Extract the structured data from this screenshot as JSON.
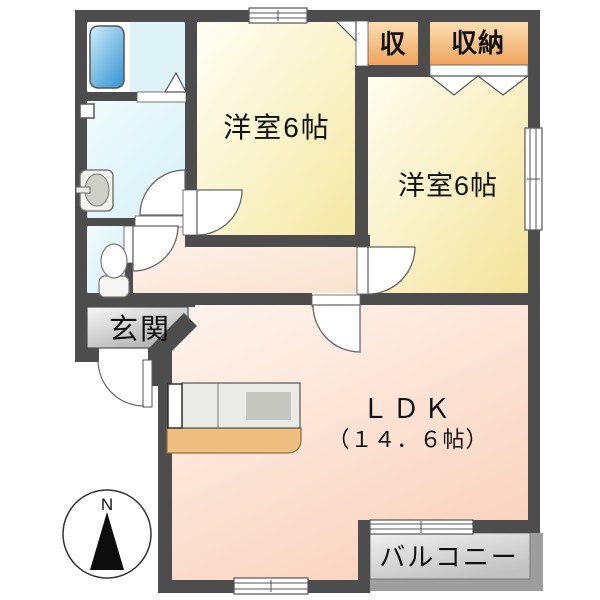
{
  "plan": {
    "rooms": {
      "bedroom1": {
        "label": "洋室6帖"
      },
      "bedroom2": {
        "label": "洋室6帖"
      },
      "ldk": {
        "label": "ＬＤＫ",
        "size": "（１４．６帖）"
      },
      "entrance": {
        "label": "玄関"
      },
      "storage_small": {
        "label": "収"
      },
      "closet": {
        "label": "収納"
      },
      "balcony": {
        "label": "バルコニー"
      }
    },
    "compass": {
      "north_label": "N"
    },
    "fixture_icons": [
      "bathtub-icon",
      "washbasin-icon",
      "toilet-icon",
      "kitchen-counter-icon",
      "compass-icon"
    ],
    "colors": {
      "wall": "#4d4d4d",
      "bedroom_yellow": "#f7ecab",
      "ldk_peach": "#fbd8c5",
      "hallway_peach": "#fdf0e4",
      "sanitary_cyan": "#dff4f8",
      "closet_orange": "#f2aa60",
      "entrance_gray": "#bdbdbd",
      "balcony_gray": "#cccccc",
      "bathtub_blue": "#4aa3d8",
      "counter_tan": "#efbe81"
    }
  }
}
